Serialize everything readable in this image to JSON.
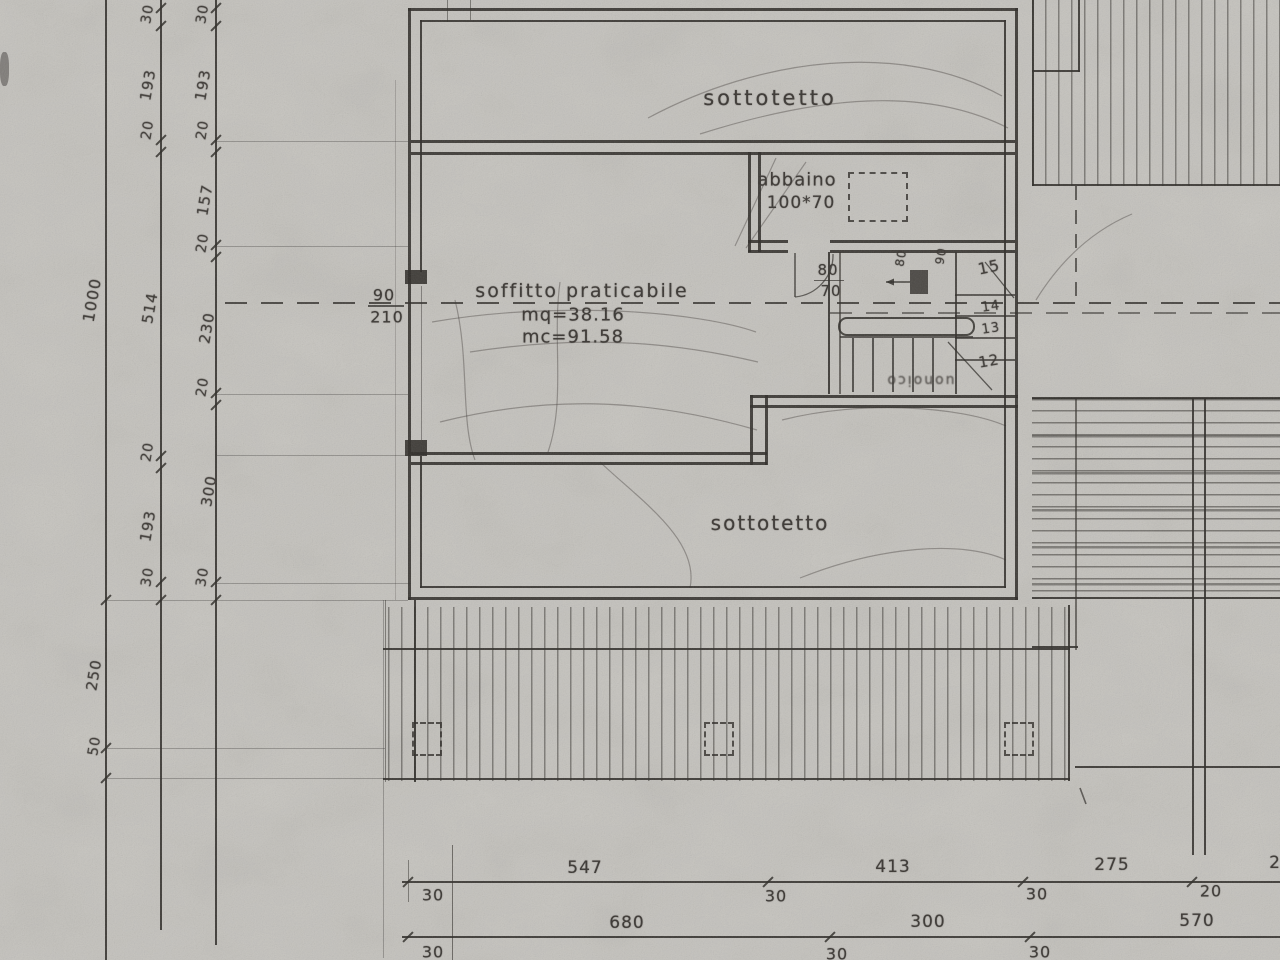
{
  "theme": {
    "paper": "#c8c6c1",
    "ink": "#2e2b27",
    "ink2": "#3a3632"
  },
  "plan": {
    "room_top": "sottotetto",
    "room_bottom": "sottotetto",
    "attic_note": {
      "line1": "soffitto praticabile",
      "line2": "mq=38.16",
      "line3": "mc=91.58"
    },
    "dormer": {
      "line1": "abbaino",
      "line2": "100*70"
    },
    "door_left": {
      "num": "90",
      "den": "210"
    },
    "stair_door": {
      "num": "80",
      "den": "70"
    },
    "stair": {
      "steps": [
        "15",
        "14",
        "13",
        "12"
      ],
      "mark_a": "80",
      "mark_b": "90",
      "note": "uonoico"
    }
  },
  "dims": {
    "left_a": [
      "1000",
      "250",
      "50"
    ],
    "left_b": [
      "30",
      "193",
      "20",
      "514",
      "20",
      "193",
      "30"
    ],
    "left_c": [
      "30",
      "193",
      "20",
      "157",
      "20",
      "230",
      "20",
      "300",
      "30"
    ],
    "bottom_row1_above": [
      "547",
      "413",
      "275",
      "2"
    ],
    "bottom_row1_below": [
      "30",
      "30",
      "30",
      "20"
    ],
    "bottom_row2_above": [
      "680",
      "300",
      "570"
    ],
    "bottom_row2_below": [
      "30",
      "30",
      "30"
    ]
  }
}
